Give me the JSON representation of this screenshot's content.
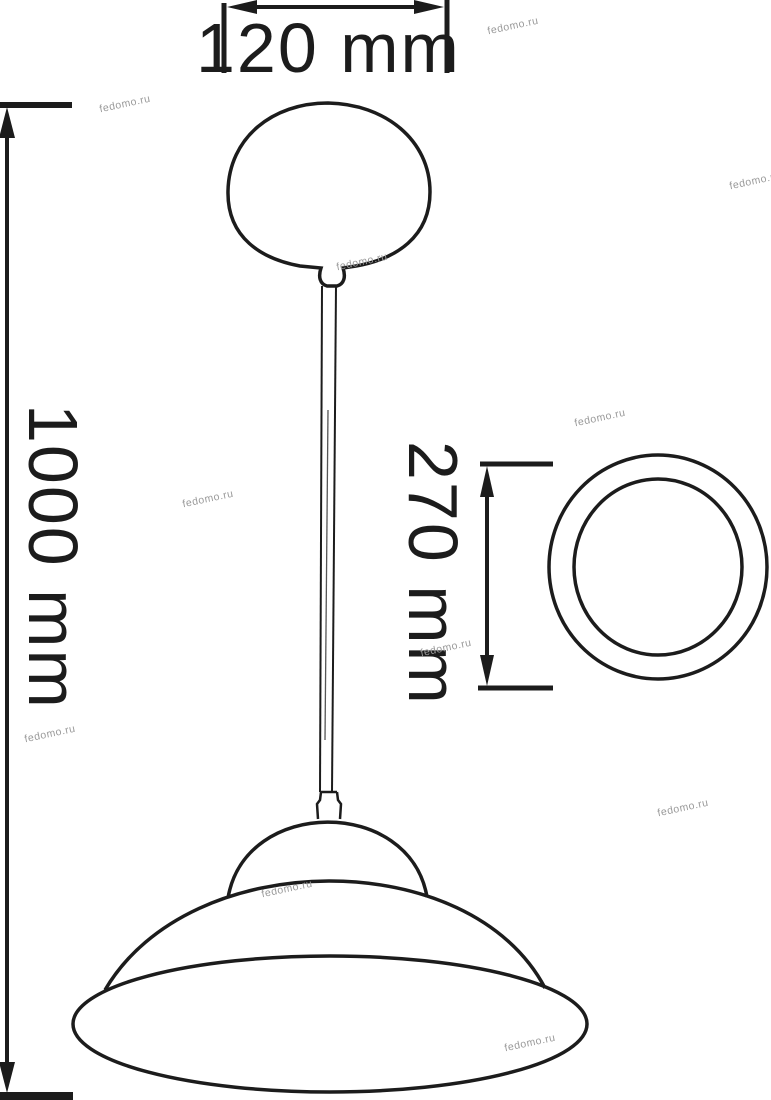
{
  "drawing": {
    "dim_width_label": "120 mm",
    "dim_height_label": "1000 mm",
    "dim_shade_label": "270 mm"
  },
  "watermark": {
    "text": "fedomo.ru"
  },
  "colors": {
    "line": "#1c1c1c",
    "watermark": "#9a9a9a",
    "background": "#ffffff"
  }
}
